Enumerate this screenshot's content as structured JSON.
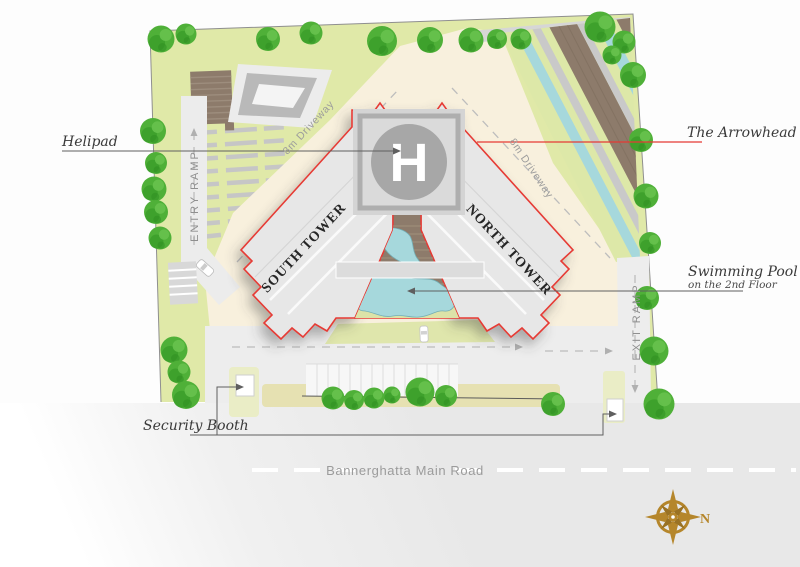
{
  "labels": {
    "helipad": "Helipad",
    "the_arrowhead": "The Arrowhead",
    "swimming_pool": "Swimming Pool",
    "swimming_pool_sub": "on the 2nd Floor",
    "security_booth": "Security Booth",
    "main_road": "Bannerghatta Main Road"
  },
  "towers": {
    "south": "SOUTH TOWER",
    "north": "NORTH TOWER"
  },
  "ramps": {
    "entry": "ENTRY RAMP",
    "exit": "EXIT RAMP"
  },
  "driveways": {
    "left": "8m Driveway",
    "right": "8m Driveway"
  },
  "markers": {
    "helipad_h": "H",
    "compass_north": "N"
  },
  "colors": {
    "outline_red": "#e63a34",
    "lawn_green": "#e0e9a8",
    "tree_green": "#4fb038",
    "driveway_cream": "#f8f0dd",
    "pool_blue": "#a6d8dc",
    "deck_brown": "#8d7b6b",
    "road_gray": "#e8e8e8",
    "compass_gold": "#b5862b"
  }
}
